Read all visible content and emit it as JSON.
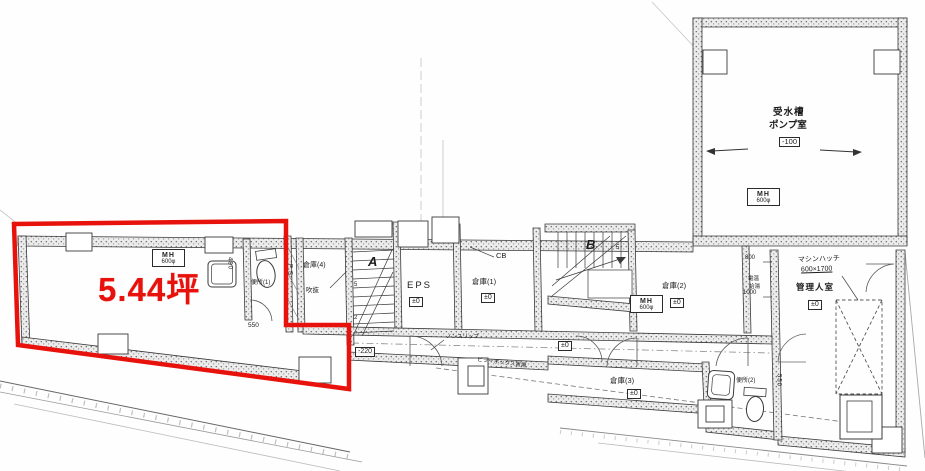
{
  "plan": {
    "highlight": {
      "area": "5.44坪"
    },
    "pump_room": {
      "line1": "受水槽",
      "line2": "ポンプ室",
      "level": "-100"
    },
    "manhole": {
      "label": "MH",
      "size": "600φ"
    },
    "rooms": {
      "storage1": "倉庫(1)",
      "storage2": "倉庫(2)",
      "storage3": "倉庫(3)",
      "storage4": "倉庫(4)",
      "toilet1": "便所(1)",
      "toilet2": "便所(2)",
      "eps": "EPS",
      "manager": "管理人室",
      "pipe_space": "P.S",
      "void_space": "吹抜"
    },
    "stairs": {
      "a": "A",
      "b": "B",
      "num5": "5",
      "num2": "2"
    },
    "levels": {
      "zero": "±0",
      "minus220": "-220"
    },
    "dims": {
      "d550": "550",
      "d800": "800",
      "d1000": "1000",
      "d480": "480"
    },
    "notes": {
      "machine_hatch": "マシンハッチ",
      "machine_hatch_size": "600×1700",
      "nonslip": "ノンスリップ",
      "pillar_box": "ピラーボックス置場",
      "water_heater": "電温",
      "hot_water": "給湯",
      "cb": "CB"
    },
    "colors": {
      "highlight_red": "#e8120c",
      "line": "#3a3a3a"
    }
  }
}
